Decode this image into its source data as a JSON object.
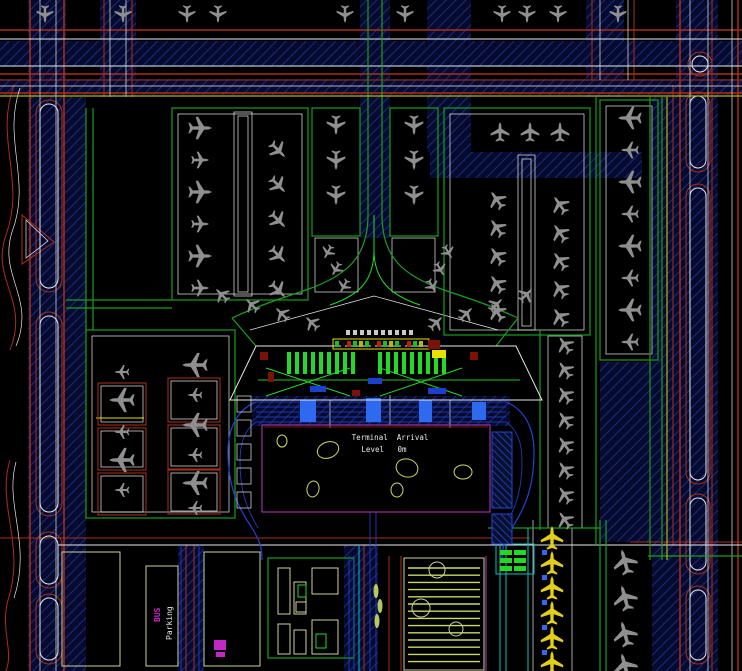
{
  "drawing": {
    "labels": {
      "terminal_arrival": "Terminal  Arrival",
      "level": "Level   0m",
      "bus": "BUS",
      "parking": "Parking"
    },
    "palette": {
      "red": "#ab2e17",
      "darkRed": "#7a1208",
      "green": "#18a01c",
      "brightGreen": "#22d926",
      "navyLine": "#1b2a80",
      "blue": "#2442d8",
      "brightBlue": "#2e6af0",
      "cyan": "#00c2c2",
      "yellow": "#b9b400",
      "brightYellow": "#e8e100",
      "stripe": "#c8dc64",
      "magenta": "#c428c4",
      "magentaDark": "#993399",
      "white": "#e8e8e8",
      "pale": "#cfcf9a",
      "planeGray": "#8f8f8f",
      "planeYellow": "#e3cf1a",
      "bg": "#000000"
    },
    "plane_path": "M0,-15 L1.8,-11 L2.2,-5 L14,2.5 L14,5.5 L2.2,1.5 L2,9 L6.5,12.5 L6.5,14.5 L0,12.5 L-6.5,14.5 L-6.5,12.5 L-2,9 L-2.2,1.5 L-14,5.5 L-14,2.5 L-2.2,-5 L-1.8,-11 Z",
    "planes": [
      [
        45,
        14,
        180,
        18
      ],
      [
        123,
        14,
        180,
        18
      ],
      [
        187,
        14,
        180,
        18
      ],
      [
        218,
        14,
        180,
        18
      ],
      [
        345,
        14,
        180,
        18
      ],
      [
        405,
        14,
        180,
        18
      ],
      [
        502,
        14,
        180,
        18
      ],
      [
        527,
        14,
        180,
        18
      ],
      [
        558,
        14,
        180,
        18
      ],
      [
        618,
        14,
        180,
        18
      ],
      [
        200,
        128,
        90,
        24
      ],
      [
        200,
        160,
        90,
        18
      ],
      [
        200,
        192,
        90,
        24
      ],
      [
        200,
        224,
        90,
        18
      ],
      [
        200,
        256,
        90,
        24
      ],
      [
        200,
        288,
        90,
        18
      ],
      [
        278,
        150,
        135,
        20
      ],
      [
        278,
        185,
        135,
        20
      ],
      [
        278,
        220,
        135,
        20
      ],
      [
        278,
        255,
        135,
        20
      ],
      [
        278,
        290,
        135,
        20
      ],
      [
        336,
        125,
        180,
        20
      ],
      [
        336,
        160,
        180,
        20
      ],
      [
        336,
        195,
        180,
        20
      ],
      [
        414,
        125,
        180,
        20
      ],
      [
        414,
        160,
        180,
        20
      ],
      [
        414,
        195,
        180,
        20
      ],
      [
        328,
        252,
        210,
        15
      ],
      [
        336,
        269,
        210,
        15
      ],
      [
        344,
        286,
        210,
        15
      ],
      [
        448,
        252,
        150,
        15
      ],
      [
        440,
        269,
        150,
        15
      ],
      [
        432,
        286,
        150,
        15
      ],
      [
        222,
        295,
        315,
        17
      ],
      [
        252,
        305,
        315,
        17
      ],
      [
        282,
        314,
        315,
        17
      ],
      [
        312,
        323,
        315,
        17
      ],
      [
        436,
        323,
        45,
        17
      ],
      [
        466,
        314,
        45,
        17
      ],
      [
        496,
        305,
        45,
        17
      ],
      [
        526,
        295,
        45,
        17
      ],
      [
        500,
        132,
        0,
        20
      ],
      [
        530,
        132,
        0,
        20
      ],
      [
        560,
        132,
        0,
        20
      ],
      [
        497,
        200,
        325,
        20
      ],
      [
        497,
        228,
        325,
        20
      ],
      [
        497,
        256,
        325,
        20
      ],
      [
        497,
        284,
        325,
        20
      ],
      [
        497,
        312,
        325,
        20
      ],
      [
        560,
        205,
        325,
        20
      ],
      [
        560,
        233,
        325,
        20
      ],
      [
        560,
        261,
        325,
        20
      ],
      [
        560,
        289,
        325,
        20
      ],
      [
        560,
        317,
        325,
        20
      ],
      [
        630,
        118,
        270,
        24
      ],
      [
        630,
        150,
        270,
        18
      ],
      [
        630,
        182,
        270,
        24
      ],
      [
        630,
        214,
        270,
        18
      ],
      [
        630,
        246,
        270,
        24
      ],
      [
        630,
        278,
        270,
        18
      ],
      [
        630,
        310,
        270,
        24
      ],
      [
        630,
        342,
        270,
        18
      ],
      [
        122,
        372,
        270,
        15
      ],
      [
        122,
        400,
        270,
        26
      ],
      [
        122,
        432,
        270,
        15
      ],
      [
        122,
        460,
        270,
        26
      ],
      [
        122,
        490,
        270,
        15
      ],
      [
        195,
        365,
        270,
        26
      ],
      [
        195,
        395,
        270,
        15
      ],
      [
        195,
        425,
        270,
        26
      ],
      [
        195,
        455,
        270,
        15
      ],
      [
        195,
        483,
        270,
        26
      ],
      [
        195,
        508,
        270,
        15
      ],
      [
        565,
        345,
        325,
        19
      ],
      [
        565,
        370,
        325,
        19
      ],
      [
        565,
        395,
        325,
        19
      ],
      [
        565,
        420,
        325,
        19
      ],
      [
        565,
        445,
        325,
        19
      ],
      [
        565,
        470,
        325,
        19
      ],
      [
        565,
        495,
        325,
        19
      ],
      [
        565,
        520,
        325,
        19
      ],
      [
        625,
        562,
        345,
        26
      ],
      [
        625,
        598,
        345,
        26
      ],
      [
        625,
        634,
        345,
        26
      ],
      [
        625,
        666,
        345,
        26
      ],
      [
        552,
        538,
        0,
        24,
        "y"
      ],
      [
        552,
        563,
        0,
        24,
        "y"
      ],
      [
        552,
        588,
        0,
        24,
        "y"
      ],
      [
        552,
        613,
        0,
        24,
        "y"
      ],
      [
        552,
        638,
        0,
        24,
        "y"
      ],
      [
        552,
        663,
        0,
        24,
        "y"
      ]
    ],
    "stand_boxes": [
      [
        98,
        383,
        48,
        42
      ],
      [
        98,
        428,
        48,
        42
      ],
      [
        98,
        473,
        48,
        42
      ],
      [
        168,
        378,
        52,
        44
      ],
      [
        168,
        425,
        52,
        44
      ],
      [
        168,
        470,
        52,
        44
      ]
    ],
    "gate_boxes": [
      [
        237,
        396
      ],
      [
        237,
        420
      ],
      [
        237,
        444
      ],
      [
        237,
        468
      ],
      [
        237,
        492
      ]
    ],
    "ponds": [
      [
        328,
        450,
        11,
        8,
        -20
      ],
      [
        313,
        489,
        6,
        8,
        10
      ],
      [
        407,
        468,
        11,
        9,
        15
      ],
      [
        463,
        472,
        9,
        7,
        0
      ],
      [
        397,
        490,
        6,
        7,
        0
      ],
      [
        282,
        441,
        5,
        6,
        0
      ]
    ],
    "trees": [
      [
        437,
        570,
        8,
        0
      ],
      [
        421,
        608,
        9,
        1
      ],
      [
        456,
        629,
        7,
        0
      ]
    ],
    "cypress": [
      [
        376,
        591
      ],
      [
        380,
        606
      ],
      [
        377,
        621
      ]
    ],
    "islands": [
      [
        300,
        400,
        16,
        22
      ],
      [
        366,
        398,
        15,
        24
      ],
      [
        419,
        400,
        13,
        22
      ],
      [
        472,
        402,
        14,
        18
      ]
    ],
    "blue_squares": [
      [
        542,
        550
      ],
      [
        542,
        575
      ],
      [
        542,
        600
      ],
      [
        542,
        625
      ],
      [
        542,
        650
      ]
    ],
    "green_stands": [
      [
        500,
        550
      ],
      [
        514,
        550
      ],
      [
        500,
        558
      ],
      [
        514,
        558
      ],
      [
        500,
        566
      ],
      [
        514,
        566
      ]
    ],
    "buildings_pale": [
      [
        278,
        568,
        12,
        46
      ],
      [
        294,
        582,
        12,
        32
      ],
      [
        312,
        568,
        26,
        26
      ],
      [
        296,
        602,
        10,
        10
      ],
      [
        278,
        624,
        12,
        30
      ],
      [
        294,
        630,
        12,
        24
      ],
      [
        312,
        620,
        26,
        34
      ]
    ],
    "buildings_green": [
      [
        298,
        585,
        8,
        12
      ],
      [
        316,
        634,
        10,
        14
      ]
    ],
    "magenta_blobs": [
      [
        214,
        640,
        12,
        10
      ],
      [
        216,
        652,
        9,
        5
      ]
    ],
    "bars": [
      {
        "x": 287,
        "y": 352,
        "count": 9,
        "step": 8,
        "w": 4,
        "h": 22
      },
      {
        "x": 378,
        "y": 352,
        "count": 9,
        "step": 8,
        "w": 4,
        "h": 22
      }
    ],
    "strip_blocks": {
      "x": 335,
      "y": 341,
      "count": 15,
      "step": 6,
      "w": 4,
      "h": 6
    },
    "strip_colors": [
      "#1fbb22",
      "#0c0c0c",
      "#c22000",
      "#1fbb22",
      "#b8b800"
    ],
    "ticks": {
      "x": 346,
      "y": 330,
      "count": 10,
      "step": 7,
      "w": 4,
      "h": 5
    },
    "stripes": {
      "x1": 408,
      "x2": 480,
      "y": 568,
      "count": 14,
      "step": 7.2
    },
    "accents_red": [
      [
        260,
        352,
        8,
        8
      ],
      [
        268,
        372,
        6,
        10
      ],
      [
        428,
        340,
        12,
        9
      ],
      [
        352,
        390,
        8,
        6
      ],
      [
        470,
        352,
        8,
        8
      ]
    ],
    "accents_blue": [
      [
        310,
        386,
        16,
        6
      ],
      [
        428,
        388,
        18,
        6
      ],
      [
        368,
        378,
        14,
        6
      ]
    ],
    "accents_yellow": [
      [
        432,
        350,
        14,
        8
      ]
    ],
    "hatch_structs": [
      [
        492,
        432,
        20,
        76
      ],
      [
        492,
        514,
        20,
        30
      ]
    ]
  }
}
